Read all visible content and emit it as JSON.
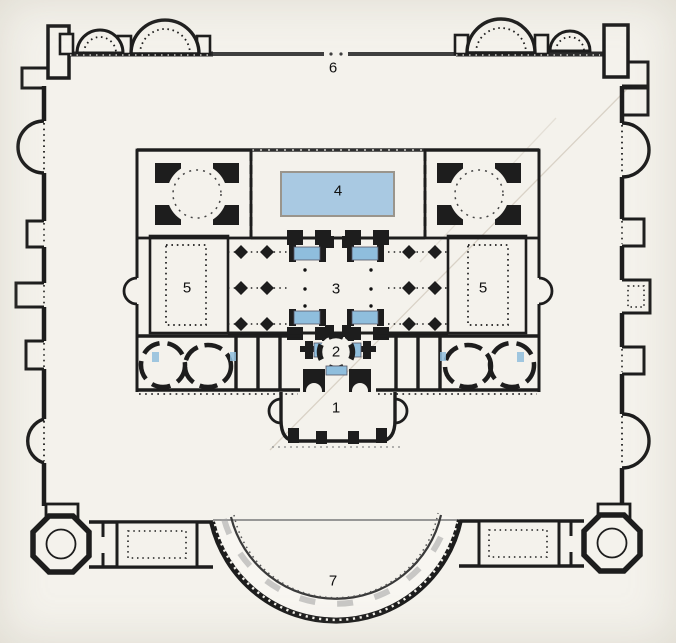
{
  "plan": {
    "kind": "scanned architectural floor plan of a Roman bath complex",
    "labels": [
      {
        "name": "area-1-caldarium",
        "text": "1"
      },
      {
        "name": "area-2-tepidarium",
        "text": "2"
      },
      {
        "name": "area-3-central-hall",
        "text": "3"
      },
      {
        "name": "area-4-pool",
        "text": "4"
      },
      {
        "name": "area-5-court-left",
        "text": "5"
      },
      {
        "name": "area-5-court-right",
        "text": "5"
      },
      {
        "name": "area-6-north-wall",
        "text": "6"
      },
      {
        "name": "area-7-hemicycle",
        "text": "7"
      }
    ],
    "colors": {
      "background": "#f4f2ec",
      "wall": "#1d1d1d",
      "wall_light": "#4f4f4f",
      "pool_large": "#a9c9e2",
      "pool_small": "#8fbedd",
      "label": "#101010"
    }
  }
}
